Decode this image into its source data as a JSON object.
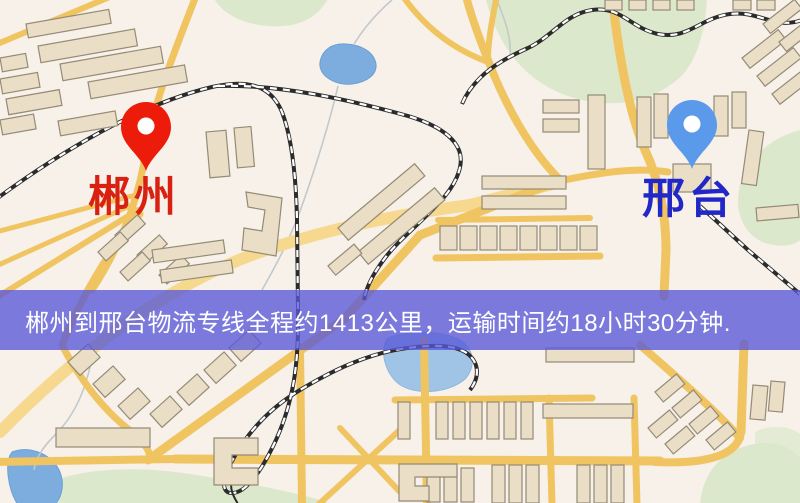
{
  "banner": {
    "text": "郴州到邢台物流专线全程约1413公里，运输时间约18小时30分钟.",
    "bg_color": "rgba(88,88,215,0.78)",
    "text_color": "#ffffff"
  },
  "route": {
    "origin": "郴州",
    "destination": "邢台",
    "distance_km": "1413",
    "duration": "18小时30分钟"
  },
  "markers": {
    "origin": {
      "label": "郴州",
      "pin_color": "#ed1c0a",
      "label_color": "#d92112"
    },
    "destination": {
      "label": "邢台",
      "pin_color": "#5b99ea",
      "label_color": "#2228c8"
    }
  },
  "map": {
    "colors": {
      "background": "#f7f1ea",
      "road": "#f0c561",
      "road_pale": "#f6d88e",
      "water": "#7cadde",
      "water_light": "#9fc4e6",
      "green": "#dce8cb",
      "building": "#eadfc6",
      "building_outline": "#948a76",
      "railway": "#2b2b2b"
    }
  }
}
